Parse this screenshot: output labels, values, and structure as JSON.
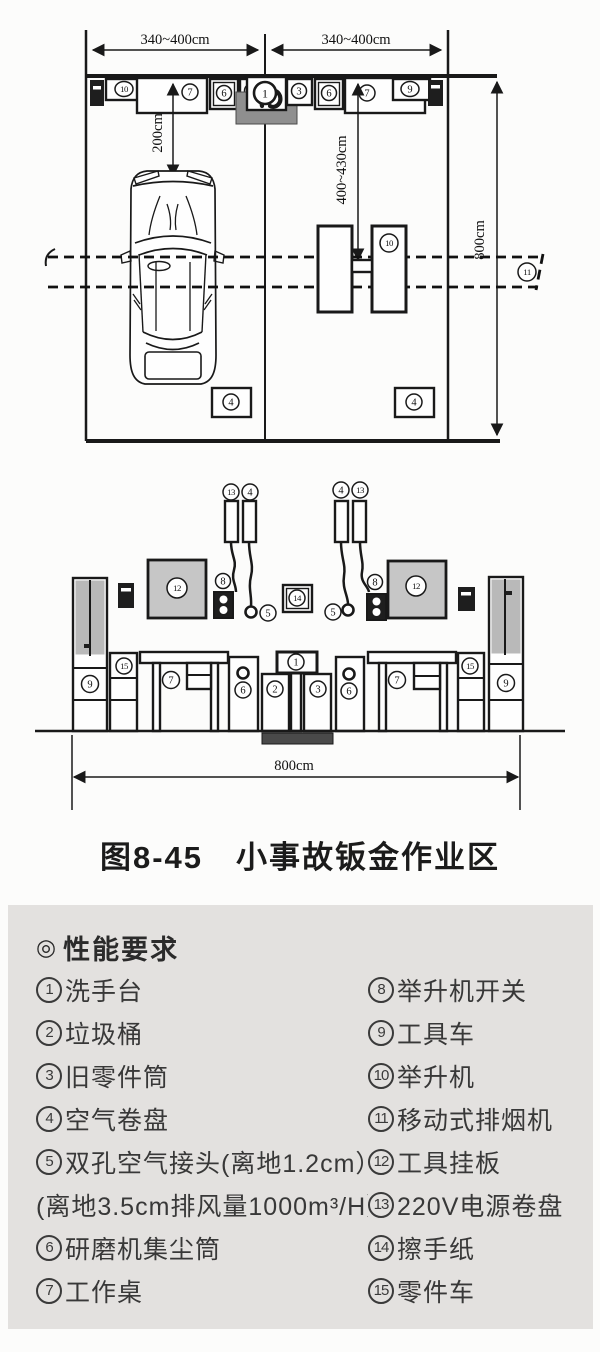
{
  "figure_caption": "图8-45　小事故钣金作业区",
  "plan": {
    "dims": {
      "top_left": "340~400cm",
      "top_right": "340~400cm",
      "right_height": "800cm",
      "car_clearance": "200cm",
      "lift_clearance": "400~430cm"
    },
    "labels": {
      "wall_box_10": "10",
      "workbench_left": "7",
      "dust_left": "6",
      "trash": "2",
      "basin": "1",
      "parts_bin": "3",
      "dust_right": "6",
      "workbench_right": "7",
      "wall_box_9": "9",
      "lift": "10",
      "smoke_rail": "11",
      "air_reel_left": "4",
      "air_reel_right": "4"
    }
  },
  "elevation": {
    "dims": {
      "width": "800cm"
    },
    "labels": {
      "power_reel_left": "13",
      "air_reel_left": "4",
      "air_reel_right": "4",
      "power_reel_right": "13",
      "tool_board_left": "12",
      "tool_board_right": "12",
      "lift_switch_left": "8",
      "lift_switch_right": "8",
      "air_conn_left": "5",
      "air_conn_right": "5",
      "paper_towel": "14",
      "tool_cart_left": "9",
      "tool_cart_right": "9",
      "parts_cart_left": "15",
      "parts_cart_right": "15",
      "table_left": "7",
      "table_right": "7",
      "dust_left": "6",
      "dust_right": "6",
      "trash": "2",
      "basin": "1",
      "parts_bin": "3"
    }
  },
  "legend": {
    "bullet": "◎",
    "title": "性能要求",
    "left": [
      {
        "num": "1",
        "text": "洗手台"
      },
      {
        "num": "2",
        "text": "垃圾桶"
      },
      {
        "num": "3",
        "text": "旧零件筒"
      },
      {
        "num": "4",
        "text": "空气卷盘"
      },
      {
        "num": "5",
        "text": "双孔空气接头(离地1.2cm）"
      },
      {
        "num": "",
        "text": "(离地3.5cm排风量1000m³/H）"
      },
      {
        "num": "6",
        "text": "研磨机集尘筒"
      },
      {
        "num": "7",
        "text": "工作桌"
      }
    ],
    "right": [
      {
        "num": "8",
        "text": "举升机开关"
      },
      {
        "num": "9",
        "text": "工具车"
      },
      {
        "num": "10",
        "text": "举升机"
      },
      {
        "num": "11",
        "text": "移动式排烟机"
      },
      {
        "num": "12",
        "text": "工具挂板"
      },
      {
        "num": "13",
        "text": "220V电源卷盘"
      },
      {
        "num": "14",
        "text": "擦手纸"
      },
      {
        "num": "15",
        "text": "零件车"
      }
    ]
  }
}
